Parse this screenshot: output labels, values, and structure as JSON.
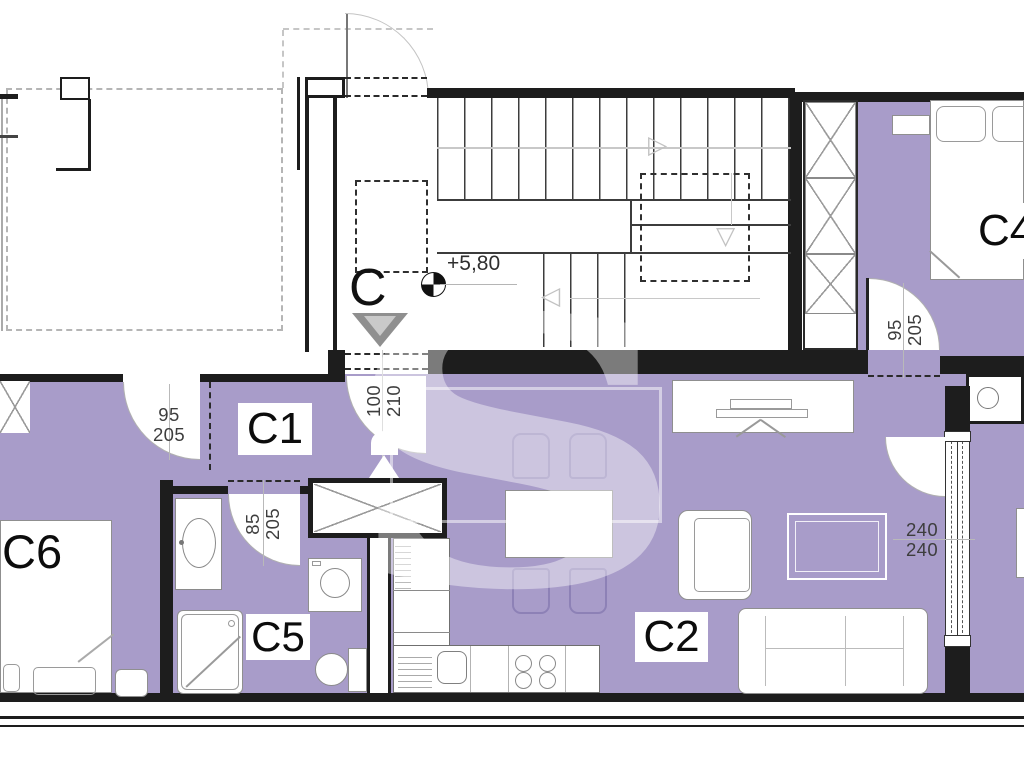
{
  "watermark": {
    "letter": "S"
  },
  "stairwell": {
    "section_label": "C",
    "elevation": "+5,80"
  },
  "rooms": {
    "c1": "C1",
    "c2": "C2",
    "c4": "C4",
    "c5": "C5",
    "c6": "C6"
  },
  "dimensions": {
    "door_c6": {
      "width": "95",
      "height": "205"
    },
    "door_c4": {
      "width": "95",
      "height": "205"
    },
    "door_c5": {
      "width": "85",
      "height": "205"
    },
    "door_entry": {
      "width": "100",
      "height": "210"
    },
    "window_living": {
      "width": "240",
      "height": "240"
    }
  },
  "colors": {
    "floor_fill": "#a89cc9",
    "wall": "#1d1d1d",
    "chair_outline": "#8d81b6",
    "watermark_overlay": "rgba(255,255,255,0.42)"
  }
}
